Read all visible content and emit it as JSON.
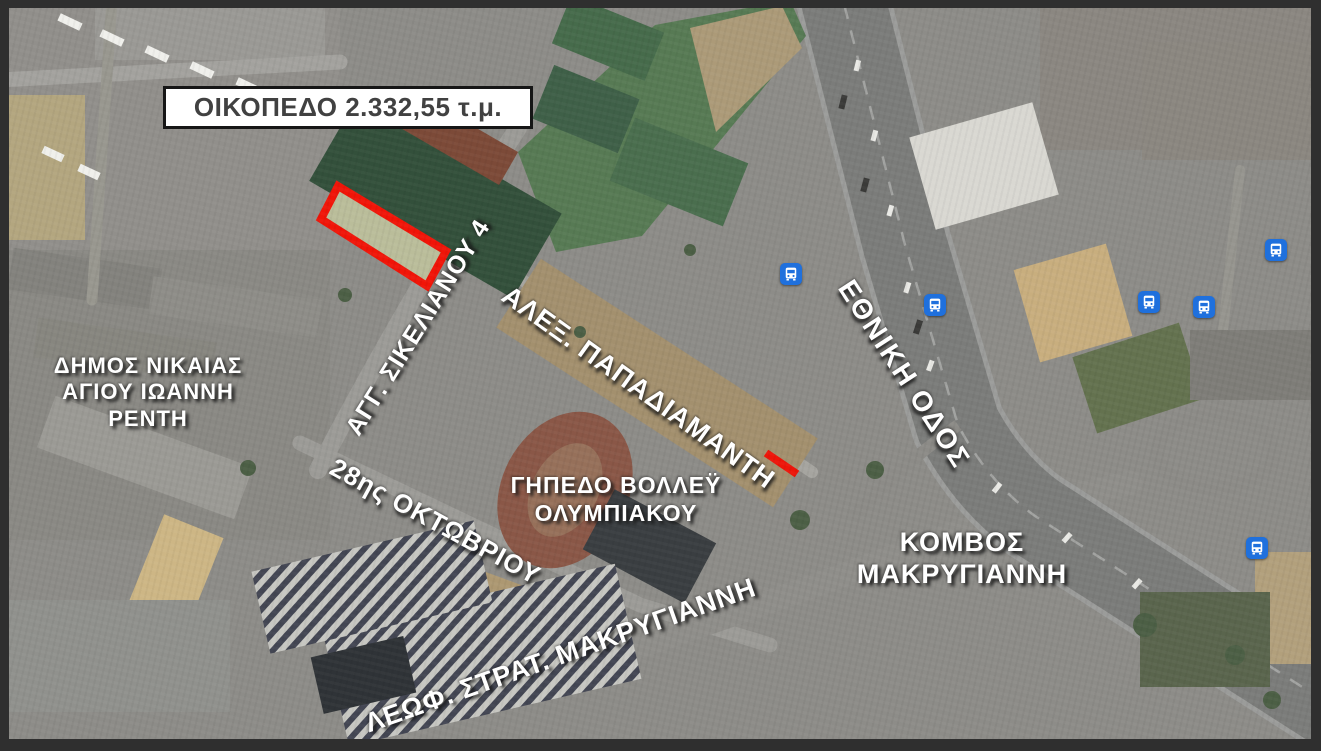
{
  "map": {
    "type": "satellite-annotated",
    "frame_color": "#2f2f2f"
  },
  "title_box": {
    "text": "ΟΙΚΟΠΕΔΟ 2.332,55 τ.μ.",
    "background": "#ffffff",
    "text_color": "#414141"
  },
  "plot": {
    "outline_color": "#f11508",
    "fill_color": "#babd9a"
  },
  "street_labels": {
    "sikelianou": "ΑΓΓ. ΣΙΚΕΛΙΑΝΟΥ 4",
    "papadiamanti": "ΑΛΕΞ. ΠΑΠΑΔΙΑΜΑΝΤΗ",
    "ethniki_odos": "ΕΘΝΙΚΗ ΟΔΟΣ",
    "oktovriou": "28ης ΟΚΤΩΒΡΙΟΥ",
    "makriyanni_ave": "ΛΕΩΦ. ΣΤΡΑΤ. ΜΑΚΡΥΓΙΑΝΝΗ"
  },
  "area_labels": {
    "municipality": {
      "line1": "ΔΗΜΟΣ ΝΙΚΑΙΑΣ",
      "line2": "ΑΓΙΟΥ ΙΩΑΝΝΗ ΡΕΝΤΗ"
    },
    "volleyball": {
      "line1": "ΓΗΠΕΔΟ ΒΟΛΛΕΫ",
      "line2": "ΟΛΥΜΠΙΑΚΟΥ"
    },
    "junction": {
      "line1": "ΚΟΜΒΟΣ",
      "line2": "ΜΑΚΡΥΓΙΑΝΝΗ"
    }
  },
  "icons": {
    "bus_stop": {
      "semantic": "bus-stop-icon",
      "color": "#1f70dd",
      "count": 6
    }
  }
}
